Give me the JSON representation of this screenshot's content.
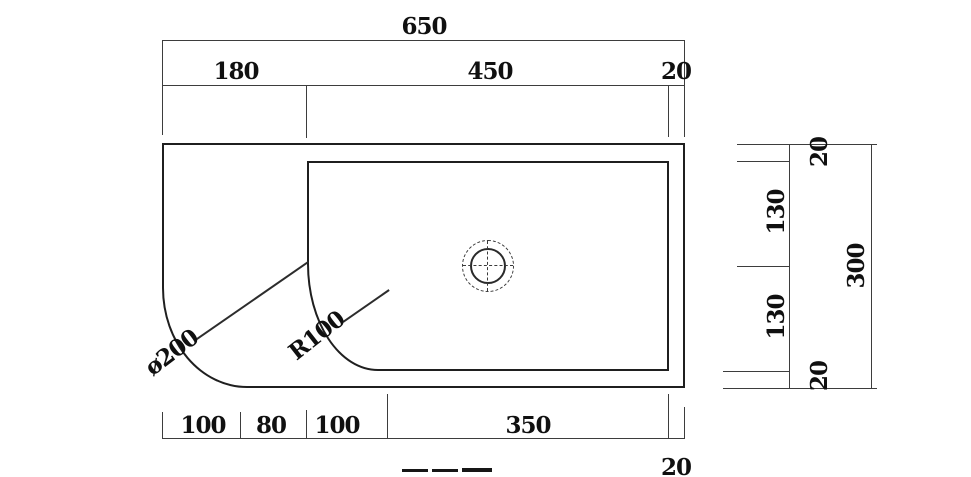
{
  "dimensions": {
    "top_overall": "650",
    "top_segments": [
      "180",
      "450",
      "20"
    ],
    "bottom_segments": [
      "100",
      "80",
      "100",
      "350"
    ],
    "bottom_corner": "20",
    "right_segments": [
      "20",
      "130",
      "130",
      "20"
    ],
    "right_overall": "300",
    "callout_outer_corner": "ø200",
    "callout_inner_corner": "R100"
  },
  "colors": {
    "outline": "#1f1f1f",
    "dimension_line": "#3d3d3d",
    "text": "#101010",
    "background": "#ffffff"
  }
}
